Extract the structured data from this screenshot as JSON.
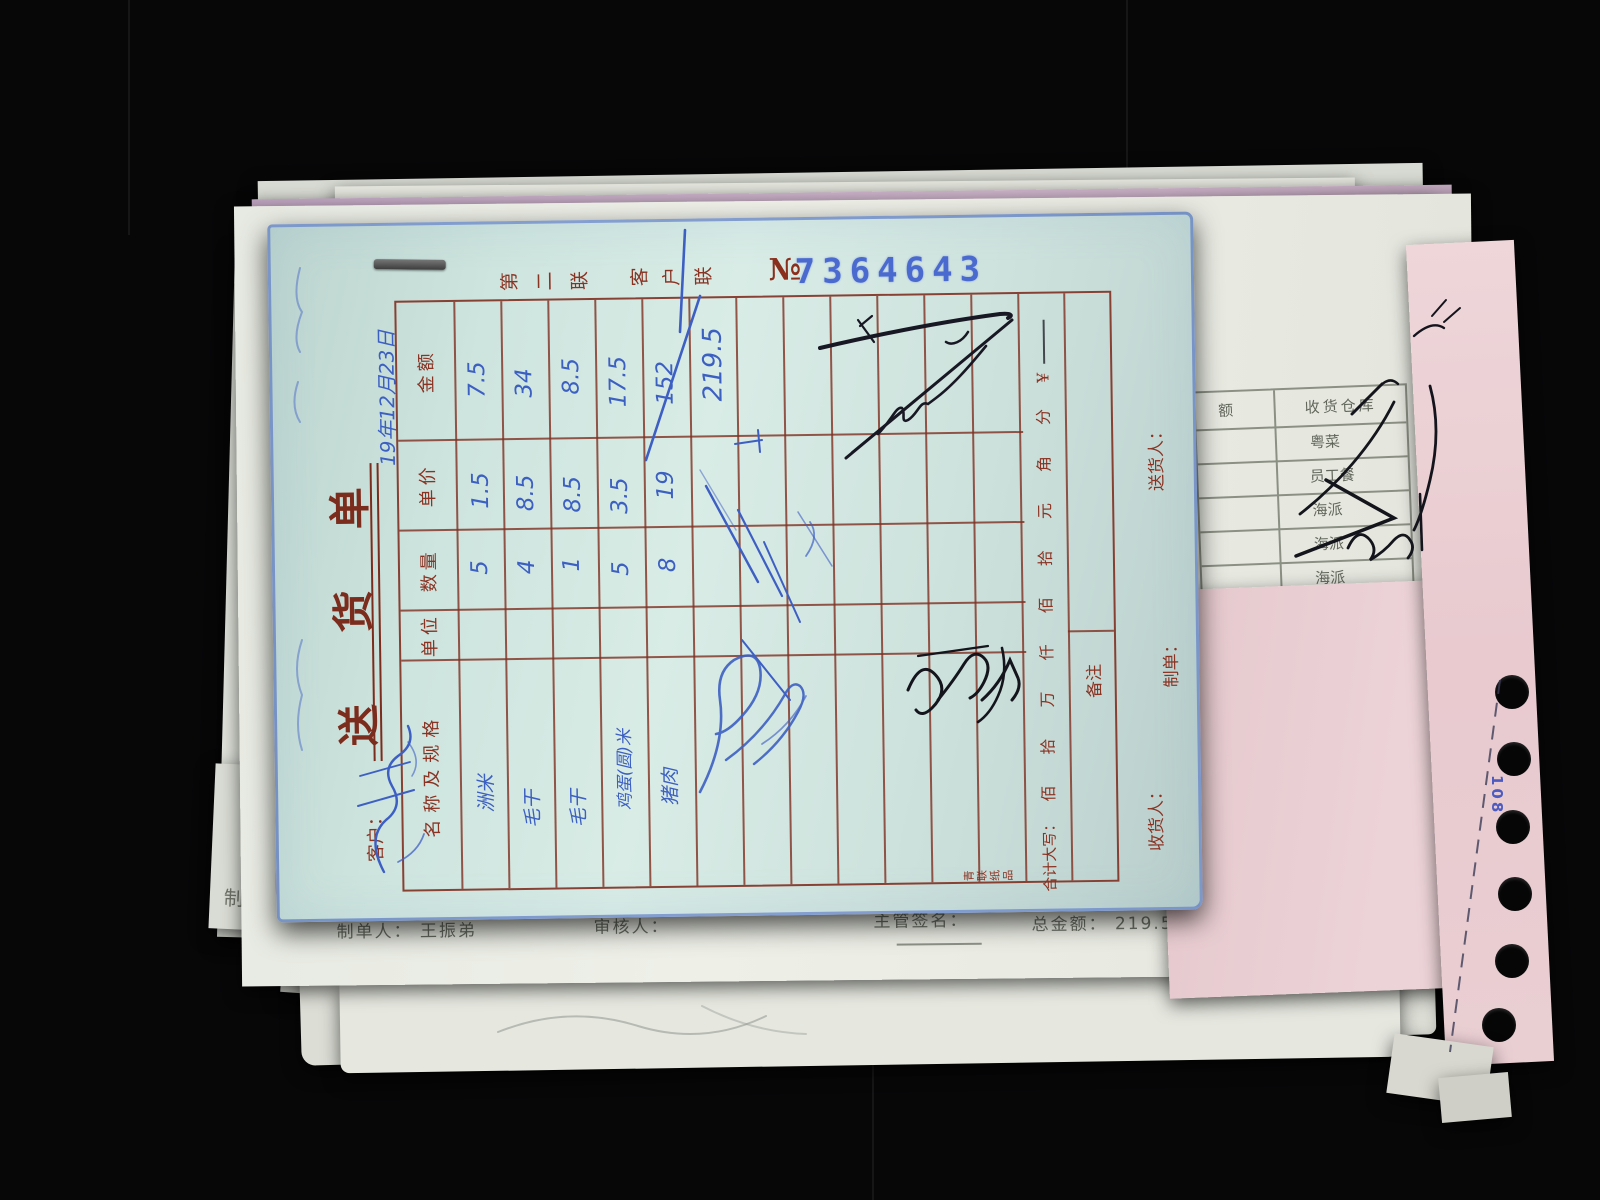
{
  "form": {
    "title_chars": [
      "送",
      "货",
      "单"
    ],
    "copy_chars_1": [
      "第",
      "二",
      "联"
    ],
    "copy_chars_2": [
      "客",
      "户",
      "联"
    ],
    "serial_prefix": "№",
    "serial_number": "7364643",
    "handwritten_date": "19年12月23日",
    "customer_label": "客户：",
    "col_amount": "金额",
    "col_unit_price": "单价",
    "col_quantity": "数量",
    "col_unit": "单位",
    "col_name_spec": "名称及规格",
    "rows": [
      {
        "name": "洲米",
        "quantity": "5",
        "unit_price": "1.5",
        "amount": "7.5"
      },
      {
        "name": "毛干",
        "quantity": "4",
        "unit_price": "8.5",
        "amount": "34"
      },
      {
        "name": "毛干",
        "quantity": "1",
        "unit_price": "8.5",
        "amount": "8.5"
      },
      {
        "name": "鸡蛋(圆)米",
        "quantity": "5",
        "unit_price": "3.5",
        "amount": "17.5"
      },
      {
        "name": "猪肉",
        "quantity": "8",
        "unit_price": "19",
        "amount": "152"
      }
    ],
    "handwritten_total": "219.5",
    "sum_caps_label": "合计大写：",
    "sum_caps_scale": "佰 拾 万 仟 佰 拾 元 角 分",
    "currency_symbol": "¥",
    "remarks_label": "备注",
    "receiver_label": "收货人：",
    "maker_label": "制单：",
    "deliverer_label": "送货人：",
    "printer_mark": [
      "青",
      "联",
      "纸",
      "品"
    ]
  },
  "footer_sheet": {
    "preparer_label": "制单人：",
    "preparer_name": "王振弟",
    "reviewer_label": "审核人：",
    "supervisor_label": "主管签名：",
    "total_label": "总金额：",
    "total_value": "219.5",
    "page_info": "第1页/共1页"
  },
  "right_sheet": {
    "amount_header_partial": "额",
    "warehouse_header": "收货仓库",
    "warehouse_rows": [
      "粤菜",
      "员工餐",
      "海派",
      "海派",
      "海派"
    ]
  },
  "under_sheet": {
    "page_info": "第1页/共1页",
    "partial_char": "制"
  },
  "edge_strip": {
    "feed_mark": "108"
  },
  "colors": {
    "form_paper": "#cfe3dd",
    "grid_red": "#7f2f20",
    "print_red": "#8a3323",
    "ink_blue": "#3c5fc2",
    "stamp_blue": "#4b6ad0",
    "ink_black": "#181824",
    "print_gray": "#6b7066"
  }
}
